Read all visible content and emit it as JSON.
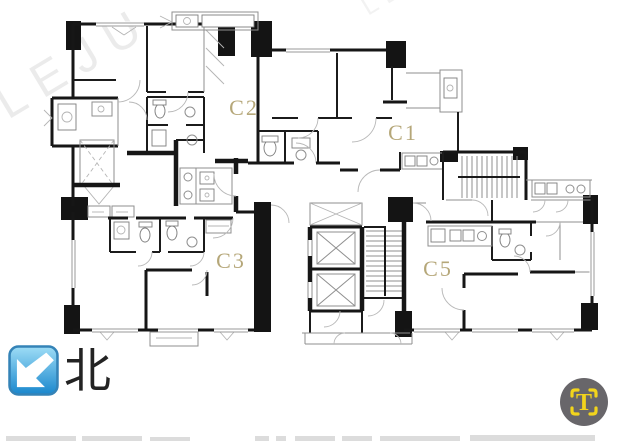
{
  "watermark": {
    "text": "LEJU",
    "color": "#dcdcdc"
  },
  "plan": {
    "label_color": "#ae9e6b",
    "unit_labels": {
      "c1": "C1",
      "c2": "C2",
      "c3": "C3",
      "c5": "C5"
    }
  },
  "north_indicator": {
    "label": "北",
    "icon": "arrow-southwest",
    "gradient_top": "#9eddf6",
    "gradient_bottom": "#1987cd",
    "border_color": "#3483b7",
    "arrow_color": "#ffffff",
    "text_color": "#232323"
  },
  "logo": {
    "letter": "T",
    "circle_color": "#68666a",
    "accent_color": "#f2d41c"
  }
}
